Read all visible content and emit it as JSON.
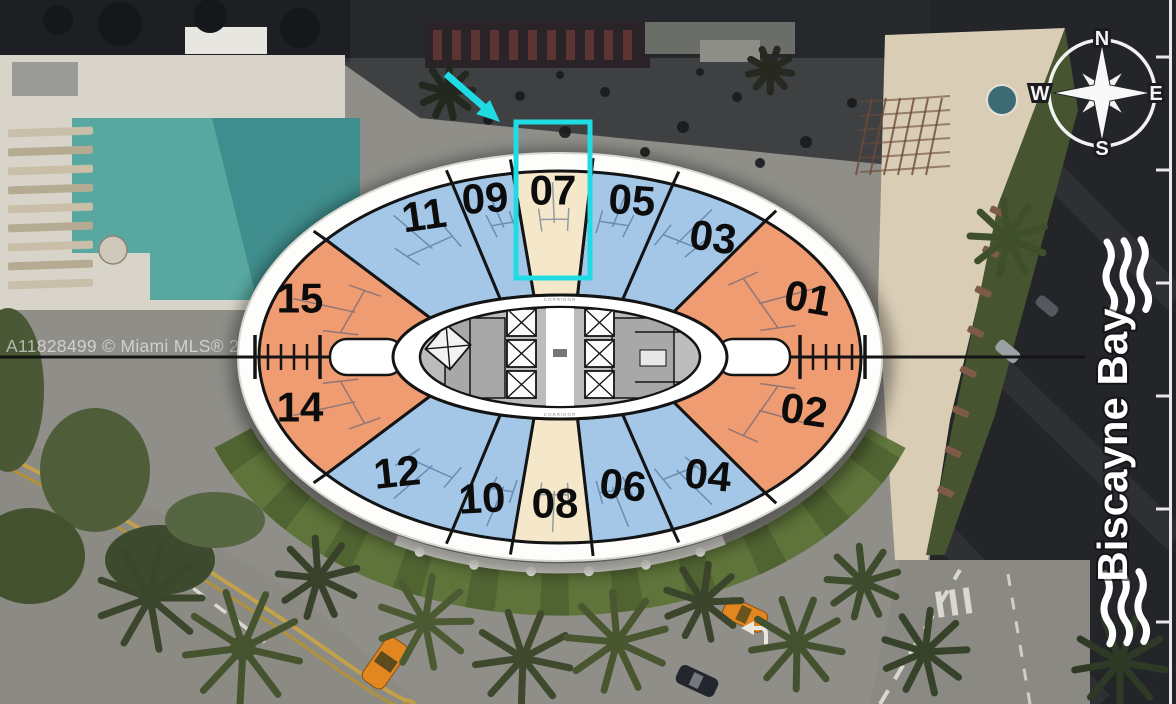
{
  "watermark": "A11828499 © Miami MLS® 2025",
  "compass": {
    "north": "N",
    "east": "E",
    "south": "S",
    "west": "W"
  },
  "bay": {
    "label": "Biscayne Bay"
  },
  "floor_plan": {
    "corridor_label": "CORRIDOR",
    "highlighted_unit": "07",
    "highlight_color": "#1fdbe3",
    "colors": {
      "blue": "#a4c7e8",
      "orange": "#f09c72",
      "cream": "#f5e7ca"
    },
    "units": [
      {
        "number": "01",
        "color": "orange"
      },
      {
        "number": "02",
        "color": "orange"
      },
      {
        "number": "03",
        "color": "blue"
      },
      {
        "number": "04",
        "color": "blue"
      },
      {
        "number": "05",
        "color": "blue"
      },
      {
        "number": "06",
        "color": "blue"
      },
      {
        "number": "07",
        "color": "cream"
      },
      {
        "number": "08",
        "color": "cream"
      },
      {
        "number": "09",
        "color": "blue"
      },
      {
        "number": "10",
        "color": "blue"
      },
      {
        "number": "11",
        "color": "blue"
      },
      {
        "number": "12",
        "color": "blue"
      },
      {
        "number": "14",
        "color": "orange"
      },
      {
        "number": "15",
        "color": "orange"
      }
    ]
  }
}
